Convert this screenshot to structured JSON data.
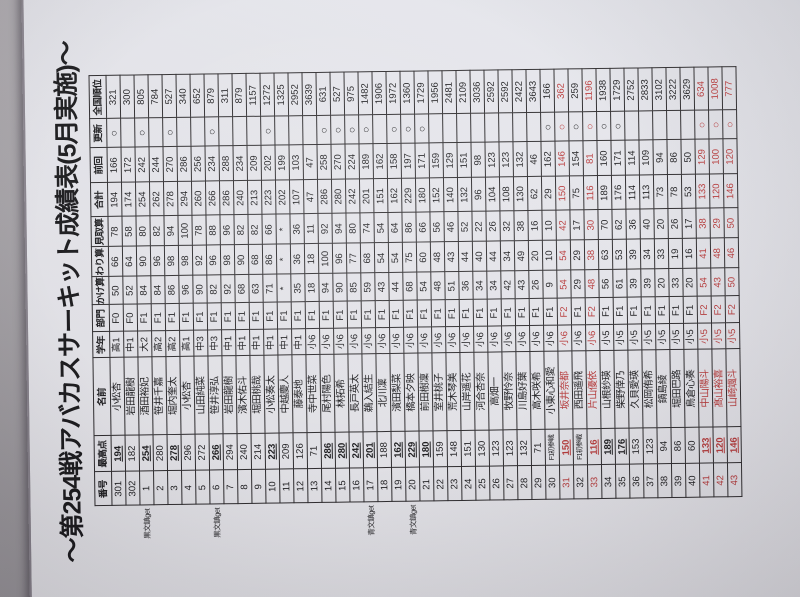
{
  "title": "～第254戦アバカスサーキット成績表(5月実施)～",
  "colors": {
    "background": "#a9a6aa",
    "paper": "#f1f1f5",
    "ink": "#1b1b1d",
    "grid": "#2e2c2e",
    "accent_red": "#bf3b3b"
  },
  "update_mark": "○",
  "columns": [
    "番号",
    "最高点",
    "名前",
    "学年",
    "部門",
    "かけ算",
    "わり算",
    "見取算",
    "合計",
    "前回",
    "更新",
    "全国順位"
  ],
  "prize_notes": {
    "black": "黒文鎮get",
    "blue": "青文鎮get"
  },
  "rows": [
    {
      "no": "301",
      "best": "194",
      "u": true,
      "first": false,
      "name": "小松杏",
      "grade": "高1",
      "cat": "F0",
      "kake": "50",
      "wari": "66",
      "mitori": "78",
      "total": "194",
      "prev": "166",
      "upd": true,
      "rank": "321",
      "red": false,
      "note": ""
    },
    {
      "no": "302",
      "best": "182",
      "u": false,
      "first": false,
      "name": "岩田龍樹",
      "grade": "中1",
      "cat": "F0",
      "kake": "52",
      "wari": "64",
      "mitori": "58",
      "total": "174",
      "prev": "172",
      "upd": false,
      "rank": "300",
      "red": false,
      "note": ""
    },
    {
      "no": "1",
      "best": "254",
      "u": true,
      "first": false,
      "name": "酒田裕妃",
      "grade": "大2",
      "cat": "F1",
      "kake": "84",
      "wari": "90",
      "mitori": "80",
      "total": "254",
      "prev": "242",
      "upd": true,
      "rank": "805",
      "red": false,
      "note": "黒文鎮get"
    },
    {
      "no": "2",
      "best": "280",
      "u": false,
      "first": false,
      "name": "笹井千嘉",
      "grade": "高2",
      "cat": "F1",
      "kake": "84",
      "wari": "96",
      "mitori": "82",
      "total": "262",
      "prev": "244",
      "upd": false,
      "rank": "784",
      "red": false,
      "note": ""
    },
    {
      "no": "3",
      "best": "278",
      "u": true,
      "first": false,
      "name": "堀内奎太",
      "grade": "高2",
      "cat": "F1",
      "kake": "86",
      "wari": "98",
      "mitori": "94",
      "total": "278",
      "prev": "270",
      "upd": true,
      "rank": "527",
      "red": false,
      "note": ""
    },
    {
      "no": "4",
      "best": "296",
      "u": false,
      "first": false,
      "name": "小松杏",
      "grade": "高1",
      "cat": "F1",
      "kake": "96",
      "wari": "98",
      "mitori": "100",
      "total": "294",
      "prev": "286",
      "upd": false,
      "rank": "340",
      "red": false,
      "note": ""
    },
    {
      "no": "5",
      "best": "272",
      "u": false,
      "first": false,
      "name": "山田純菜",
      "grade": "中3",
      "cat": "F1",
      "kake": "90",
      "wari": "92",
      "mitori": "78",
      "total": "260",
      "prev": "256",
      "upd": false,
      "rank": "652",
      "red": false,
      "note": ""
    },
    {
      "no": "6",
      "best": "266",
      "u": true,
      "first": false,
      "name": "笹井淳弘",
      "grade": "中3",
      "cat": "F1",
      "kake": "82",
      "wari": "96",
      "mitori": "88",
      "total": "266",
      "prev": "234",
      "upd": true,
      "rank": "879",
      "red": false,
      "note": "黒文鎮get"
    },
    {
      "no": "7",
      "best": "294",
      "u": false,
      "first": false,
      "name": "岩田龍樹",
      "grade": "中1",
      "cat": "F1",
      "kake": "92",
      "wari": "98",
      "mitori": "96",
      "total": "286",
      "prev": "288",
      "upd": false,
      "rank": "311",
      "red": false,
      "note": ""
    },
    {
      "no": "8",
      "best": "240",
      "u": false,
      "first": false,
      "name": "濱木佑斗",
      "grade": "中1",
      "cat": "F1",
      "kake": "68",
      "wari": "90",
      "mitori": "82",
      "total": "240",
      "prev": "234",
      "upd": false,
      "rank": "879",
      "red": false,
      "note": ""
    },
    {
      "no": "9",
      "best": "214",
      "u": false,
      "first": false,
      "name": "堀田桃哉",
      "grade": "中1",
      "cat": "F1",
      "kake": "63",
      "wari": "68",
      "mitori": "82",
      "total": "213",
      "prev": "209",
      "upd": false,
      "rank": "1157",
      "red": false,
      "note": ""
    },
    {
      "no": "10",
      "best": "223",
      "u": true,
      "first": false,
      "name": "小松奏太",
      "grade": "中1",
      "cat": "F1",
      "kake": "71",
      "wari": "86",
      "mitori": "66",
      "total": "223",
      "prev": "202",
      "upd": true,
      "rank": "1272",
      "red": false,
      "note": ""
    },
    {
      "no": "11",
      "best": "209",
      "u": false,
      "first": false,
      "name": "中越慶人",
      "grade": "中1",
      "cat": "F1",
      "kake": "*",
      "wari": "*",
      "mitori": "*",
      "total": "202",
      "prev": "199",
      "upd": false,
      "rank": "1325",
      "red": false,
      "note": ""
    },
    {
      "no": "12",
      "best": "126",
      "u": false,
      "first": false,
      "name": "藤泰地",
      "grade": "中1",
      "cat": "F1",
      "kake": "35",
      "wari": "36",
      "mitori": "36",
      "total": "107",
      "prev": "103",
      "upd": false,
      "rank": "2952",
      "red": false,
      "note": ""
    },
    {
      "no": "13",
      "best": "71",
      "u": false,
      "first": false,
      "name": "寺中世菜",
      "grade": "小6",
      "cat": "F1",
      "kake": "18",
      "wari": "18",
      "mitori": "11",
      "total": "47",
      "prev": "47",
      "upd": false,
      "rank": "3639",
      "red": false,
      "note": ""
    },
    {
      "no": "14",
      "best": "286",
      "u": true,
      "first": false,
      "name": "尾村陽色",
      "grade": "小6",
      "cat": "F1",
      "kake": "94",
      "wari": "100",
      "mitori": "92",
      "total": "286",
      "prev": "258",
      "upd": true,
      "rank": "631",
      "red": false,
      "note": ""
    },
    {
      "no": "15",
      "best": "280",
      "u": true,
      "first": false,
      "name": "林拓希",
      "grade": "小6",
      "cat": "F1",
      "kake": "90",
      "wari": "96",
      "mitori": "94",
      "total": "280",
      "prev": "270",
      "upd": true,
      "rank": "527",
      "red": false,
      "note": ""
    },
    {
      "no": "16",
      "best": "242",
      "u": true,
      "first": false,
      "name": "長戸英太",
      "grade": "小6",
      "cat": "F1",
      "kake": "85",
      "wari": "77",
      "mitori": "80",
      "total": "242",
      "prev": "224",
      "upd": true,
      "rank": "975",
      "red": false,
      "note": ""
    },
    {
      "no": "17",
      "best": "201",
      "u": true,
      "first": false,
      "name": "鵜入結生",
      "grade": "小6",
      "cat": "F1",
      "kake": "59",
      "wari": "68",
      "mitori": "74",
      "total": "201",
      "prev": "189",
      "upd": true,
      "rank": "1482",
      "red": false,
      "note": "青文鎮get"
    },
    {
      "no": "18",
      "best": "188",
      "u": false,
      "first": false,
      "name": "北川凜",
      "grade": "小6",
      "cat": "F1",
      "kake": "43",
      "wari": "54",
      "mitori": "54",
      "total": "151",
      "prev": "162",
      "upd": false,
      "rank": "1906",
      "red": false,
      "note": ""
    },
    {
      "no": "19",
      "best": "162",
      "u": true,
      "first": false,
      "name": "濱田梨菜",
      "grade": "小6",
      "cat": "F1",
      "kake": "44",
      "wari": "54",
      "mitori": "64",
      "total": "162",
      "prev": "158",
      "upd": true,
      "rank": "1972",
      "red": false,
      "note": ""
    },
    {
      "no": "20",
      "best": "229",
      "u": true,
      "first": false,
      "name": "橋本夕映",
      "grade": "小6",
      "cat": "F1",
      "kake": "68",
      "wari": "75",
      "mitori": "86",
      "total": "229",
      "prev": "197",
      "upd": true,
      "rank": "1360",
      "red": false,
      "note": "青文鎮get"
    },
    {
      "no": "21",
      "best": "180",
      "u": true,
      "first": false,
      "name": "前田樹凜",
      "grade": "小6",
      "cat": "F1",
      "kake": "54",
      "wari": "60",
      "mitori": "66",
      "total": "180",
      "prev": "171",
      "upd": true,
      "rank": "1729",
      "red": false,
      "note": ""
    },
    {
      "no": "22",
      "best": "159",
      "u": false,
      "first": false,
      "name": "室井桃子",
      "grade": "小6",
      "cat": "F1",
      "kake": "48",
      "wari": "48",
      "mitori": "56",
      "total": "152",
      "prev": "159",
      "upd": false,
      "rank": "1956",
      "red": false,
      "note": ""
    },
    {
      "no": "23",
      "best": "148",
      "u": false,
      "first": false,
      "name": "荒木琴美",
      "grade": "小6",
      "cat": "F1",
      "kake": "51",
      "wari": "43",
      "mitori": "46",
      "total": "140",
      "prev": "129",
      "upd": false,
      "rank": "2481",
      "red": false,
      "note": ""
    },
    {
      "no": "24",
      "best": "151",
      "u": false,
      "first": false,
      "name": "山岸遥花",
      "grade": "小6",
      "cat": "F1",
      "kake": "36",
      "wari": "44",
      "mitori": "52",
      "total": "132",
      "prev": "151",
      "upd": false,
      "rank": "2109",
      "red": false,
      "note": ""
    },
    {
      "no": "25",
      "best": "130",
      "u": false,
      "first": false,
      "name": "河合杏奈",
      "grade": "小6",
      "cat": "F1",
      "kake": "34",
      "wari": "40",
      "mitori": "22",
      "total": "96",
      "prev": "98",
      "upd": false,
      "rank": "3036",
      "red": false,
      "note": ""
    },
    {
      "no": "26",
      "best": "123",
      "u": false,
      "first": false,
      "name": "高畑一",
      "grade": "小6",
      "cat": "F1",
      "kake": "34",
      "wari": "44",
      "mitori": "26",
      "total": "104",
      "prev": "123",
      "upd": false,
      "rank": "2592",
      "red": false,
      "note": ""
    },
    {
      "no": "27",
      "best": "123",
      "u": false,
      "first": false,
      "name": "牧野怜奈",
      "grade": "小6",
      "cat": "F1",
      "kake": "42",
      "wari": "34",
      "mitori": "32",
      "total": "108",
      "prev": "123",
      "upd": false,
      "rank": "2592",
      "red": false,
      "note": ""
    },
    {
      "no": "28",
      "best": "132",
      "u": false,
      "first": false,
      "name": "川島好葉",
      "grade": "小6",
      "cat": "F1",
      "kake": "43",
      "wari": "49",
      "mitori": "38",
      "total": "130",
      "prev": "132",
      "upd": false,
      "rank": "2422",
      "red": false,
      "note": ""
    },
    {
      "no": "29",
      "best": "71",
      "u": false,
      "first": false,
      "name": "高木咲希",
      "grade": "小6",
      "cat": "F1",
      "kake": "26",
      "wari": "20",
      "mitori": "16",
      "total": "62",
      "prev": "46",
      "upd": false,
      "rank": "3643",
      "red": false,
      "note": ""
    },
    {
      "no": "30",
      "best": "F1初参戦",
      "u": false,
      "first": true,
      "name": "小東心和愛",
      "grade": "小6",
      "cat": "F1",
      "kake": "9",
      "wari": "10",
      "mitori": "10",
      "total": "29",
      "prev": "162",
      "upd": true,
      "rank": "166",
      "red": false,
      "note": ""
    },
    {
      "no": "31",
      "best": "150",
      "u": true,
      "first": false,
      "name": "坂井奈都",
      "grade": "小6",
      "cat": "F2",
      "kake": "54",
      "wari": "54",
      "mitori": "42",
      "total": "150",
      "prev": "146",
      "upd": true,
      "rank": "362",
      "red": true,
      "note": ""
    },
    {
      "no": "32",
      "best": "F1初参戦",
      "u": false,
      "first": true,
      "name": "西田遥飛",
      "grade": "小6",
      "cat": "F1",
      "kake": "29",
      "wari": "29",
      "mitori": "17",
      "total": "75",
      "prev": "154",
      "upd": true,
      "rank": "259",
      "red": false,
      "note": ""
    },
    {
      "no": "33",
      "best": "116",
      "u": true,
      "first": false,
      "name": "片山優依",
      "grade": "小6",
      "cat": "F2",
      "kake": "48",
      "wari": "38",
      "mitori": "30",
      "total": "116",
      "prev": "81",
      "upd": true,
      "rank": "1196",
      "red": true,
      "note": ""
    },
    {
      "no": "34",
      "best": "189",
      "u": true,
      "first": false,
      "name": "山根紗瑛",
      "grade": "小5",
      "cat": "F1",
      "kake": "56",
      "wari": "63",
      "mitori": "70",
      "total": "189",
      "prev": "160",
      "upd": true,
      "rank": "1938",
      "red": false,
      "note": ""
    },
    {
      "no": "35",
      "best": "176",
      "u": true,
      "first": false,
      "name": "柴野倖乃",
      "grade": "小5",
      "cat": "F1",
      "kake": "61",
      "wari": "53",
      "mitori": "62",
      "total": "176",
      "prev": "171",
      "upd": true,
      "rank": "1729",
      "red": false,
      "note": ""
    },
    {
      "no": "36",
      "best": "153",
      "u": false,
      "first": false,
      "name": "久貝愛瑛",
      "grade": "小5",
      "cat": "F1",
      "kake": "39",
      "wari": "39",
      "mitori": "36",
      "total": "114",
      "prev": "114",
      "upd": false,
      "rank": "2752",
      "red": false,
      "note": ""
    },
    {
      "no": "37",
      "best": "123",
      "u": false,
      "first": false,
      "name": "松岡侑希",
      "grade": "小5",
      "cat": "F1",
      "kake": "39",
      "wari": "34",
      "mitori": "40",
      "total": "113",
      "prev": "109",
      "upd": false,
      "rank": "2833",
      "red": false,
      "note": ""
    },
    {
      "no": "38",
      "best": "94",
      "u": false,
      "first": false,
      "name": "鍋島綾",
      "grade": "小5",
      "cat": "F1",
      "kake": "20",
      "wari": "33",
      "mitori": "20",
      "total": "73",
      "prev": "94",
      "upd": false,
      "rank": "3102",
      "red": false,
      "note": ""
    },
    {
      "no": "39",
      "best": "86",
      "u": false,
      "first": false,
      "name": "堀田巴路",
      "grade": "小5",
      "cat": "F1",
      "kake": "33",
      "wari": "19",
      "mitori": "26",
      "total": "78",
      "prev": "86",
      "upd": false,
      "rank": "3222",
      "red": false,
      "note": ""
    },
    {
      "no": "40",
      "best": "60",
      "u": false,
      "first": false,
      "name": "鳥倉心奏",
      "grade": "小5",
      "cat": "F1",
      "kake": "20",
      "wari": "16",
      "mitori": "17",
      "total": "53",
      "prev": "50",
      "upd": false,
      "rank": "3629",
      "red": false,
      "note": ""
    },
    {
      "no": "41",
      "best": "133",
      "u": true,
      "first": false,
      "name": "中山陽斗",
      "grade": "小5",
      "cat": "F2",
      "kake": "54",
      "wari": "41",
      "mitori": "38",
      "total": "133",
      "prev": "129",
      "upd": true,
      "rank": "634",
      "red": true,
      "note": ""
    },
    {
      "no": "42",
      "best": "120",
      "u": true,
      "first": false,
      "name": "髙山裕喜",
      "grade": "小5",
      "cat": "F2",
      "kake": "43",
      "wari": "48",
      "mitori": "29",
      "total": "120",
      "prev": "100",
      "upd": true,
      "rank": "1008",
      "red": true,
      "note": ""
    },
    {
      "no": "43",
      "best": "146",
      "u": true,
      "first": false,
      "name": "山崎颯斗",
      "grade": "小5",
      "cat": "F2",
      "kake": "50",
      "wari": "46",
      "mitori": "50",
      "total": "146",
      "prev": "120",
      "upd": true,
      "rank": "777",
      "red": true,
      "note": ""
    }
  ]
}
